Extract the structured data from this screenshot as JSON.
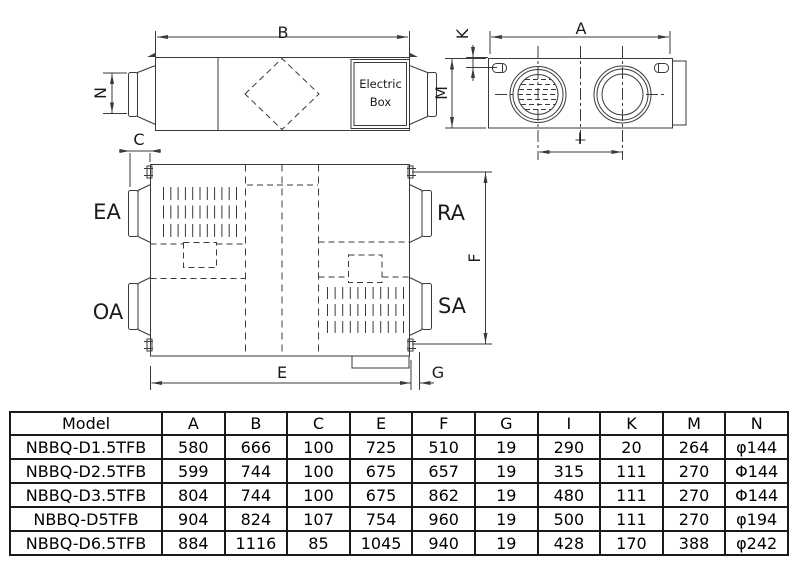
{
  "diagram": {
    "dimension_labels": {
      "B": "B",
      "N": "N",
      "C": "C",
      "M": "M",
      "K": "K",
      "A": "A",
      "I": "I",
      "F": "F",
      "E": "E",
      "G": "G"
    },
    "port_labels": {
      "EA": "EA",
      "RA": "RA",
      "OA": "OA",
      "SA": "SA"
    },
    "electric_box": {
      "line1": "Electric",
      "line2": "Box"
    }
  },
  "table": {
    "headers": [
      "Model",
      "A",
      "B",
      "C",
      "E",
      "F",
      "G",
      "I",
      "K",
      "M",
      "N"
    ],
    "rows": [
      [
        "NBBQ-D1.5TFB",
        "580",
        "666",
        "100",
        "725",
        "510",
        "19",
        "290",
        "20",
        "264",
        "φ144"
      ],
      [
        "NBBQ-D2.5TFB",
        "599",
        "744",
        "100",
        "675",
        "657",
        "19",
        "315",
        "111",
        "270",
        "Φ144"
      ],
      [
        "NBBQ-D3.5TFB",
        "804",
        "744",
        "100",
        "675",
        "862",
        "19",
        "480",
        "111",
        "270",
        "Φ144"
      ],
      [
        "NBBQ-D5TFB",
        "904",
        "824",
        "107",
        "754",
        "960",
        "19",
        "500",
        "111",
        "270",
        "φ194"
      ],
      [
        "NBBQ-D6.5TFB",
        "884",
        "1116",
        "85",
        "1045",
        "940",
        "19",
        "428",
        "170",
        "388",
        "φ242"
      ]
    ]
  },
  "colors": {
    "line": "#3a3a3a",
    "text": "#111111",
    "background": "#ffffff"
  }
}
